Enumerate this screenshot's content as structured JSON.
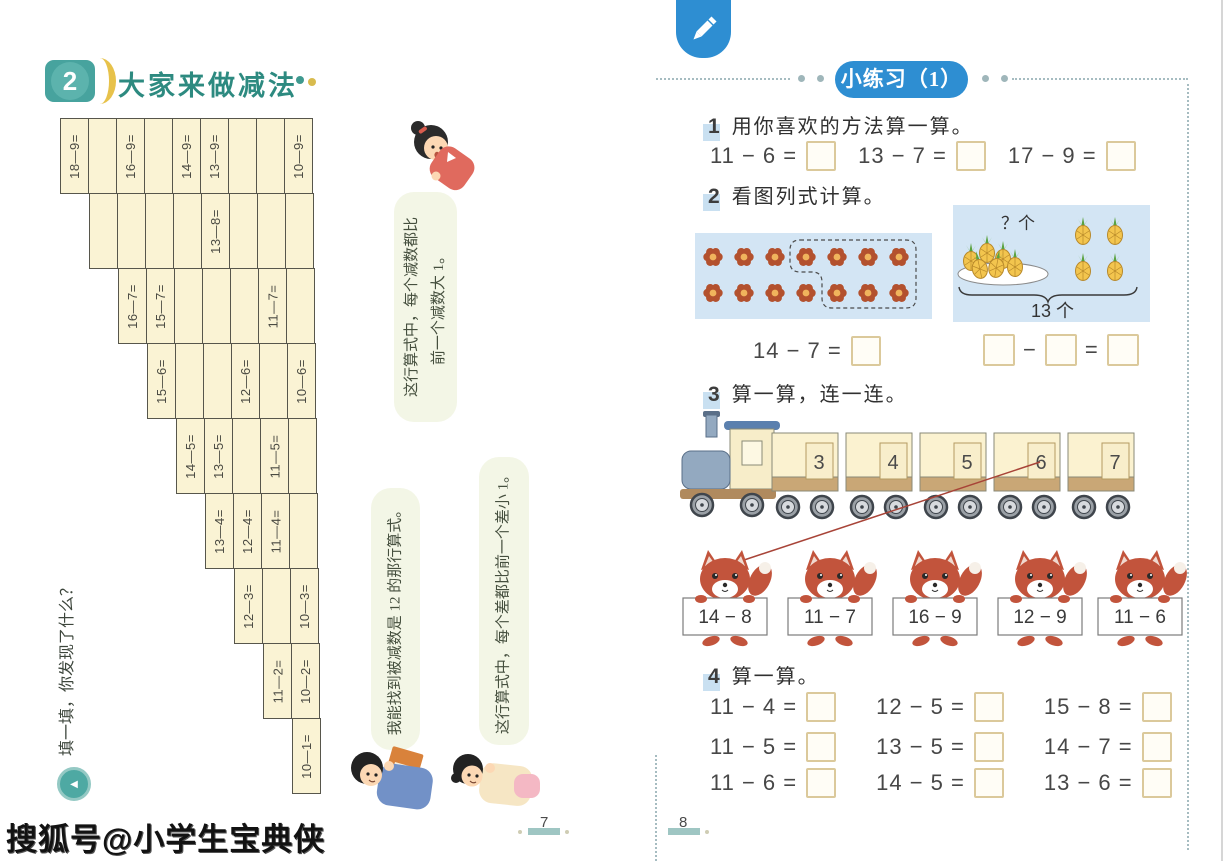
{
  "watermark": "搜狐号@小学生宝典侠",
  "left_page": {
    "lesson_number": "2",
    "title": "大家来做减法",
    "side_prompt": "填一填，你发现了什么？",
    "page_number": "7",
    "grid_rows": [
      {
        "cells": [
          "18—9=",
          "",
          "16—9=",
          "",
          "14—9=",
          "13—9=",
          "",
          "",
          "10—9="
        ]
      },
      {
        "cells": [
          "",
          "",
          "",
          "",
          "13—8=",
          "",
          "",
          ""
        ]
      },
      {
        "cells": [
          "16—7=",
          "15—7=",
          "",
          "",
          "",
          "11—7=",
          ""
        ]
      },
      {
        "cells": [
          "15—6=",
          "",
          "",
          "12—6=",
          "",
          "10—6="
        ]
      },
      {
        "cells": [
          "14—5=",
          "13—5=",
          "",
          "11—5=",
          ""
        ]
      },
      {
        "cells": [
          "13—4=",
          "12—4=",
          "11—4=",
          ""
        ]
      },
      {
        "cells": [
          "12—3=",
          "",
          "10—3="
        ]
      },
      {
        "cells": [
          "11—2=",
          "10—2="
        ]
      },
      {
        "cells": [
          "10—1="
        ]
      }
    ],
    "speech_bubbles": [
      {
        "lines": [
          "这行算式中，每个减数都比",
          "前一个减数大 1。"
        ]
      },
      {
        "lines": [
          "我能找到被减数是 12 的那行算式。"
        ]
      },
      {
        "lines": [
          "这行算式中，每个差都比前一个差小 1。"
        ]
      }
    ]
  },
  "right_page": {
    "header_badge": "小练习（1）",
    "page_number": "8",
    "problem1": {
      "num": "1",
      "title": "用你喜欢的方法算一算。",
      "expressions": [
        "11 − 6 =",
        "13 − 7 =",
        "17 − 9 ="
      ]
    },
    "problem2": {
      "num": "2",
      "title": "看图列式计算。",
      "flower_expression": "14 − 7 =",
      "question_label": "？个",
      "total_label": "13 个",
      "minus_sign": "−",
      "equals_sign": "="
    },
    "problem3": {
      "num": "3",
      "title": "算一算，连一连。",
      "train_numbers": [
        "3",
        "4",
        "5",
        "6",
        "7"
      ],
      "cards": [
        "14 − 8",
        "11 − 7",
        "16 − 9",
        "12 − 9",
        "11 − 6"
      ]
    },
    "problem4": {
      "num": "4",
      "title": "算一算。",
      "expressions": [
        [
          "11 − 4 =",
          "12 − 5 =",
          "15 − 8 ="
        ],
        [
          "11 − 5 =",
          "13 − 5 =",
          "14 − 7 ="
        ],
        [
          "11 − 6 =",
          "14 − 5 =",
          "13 − 6 ="
        ]
      ]
    }
  }
}
